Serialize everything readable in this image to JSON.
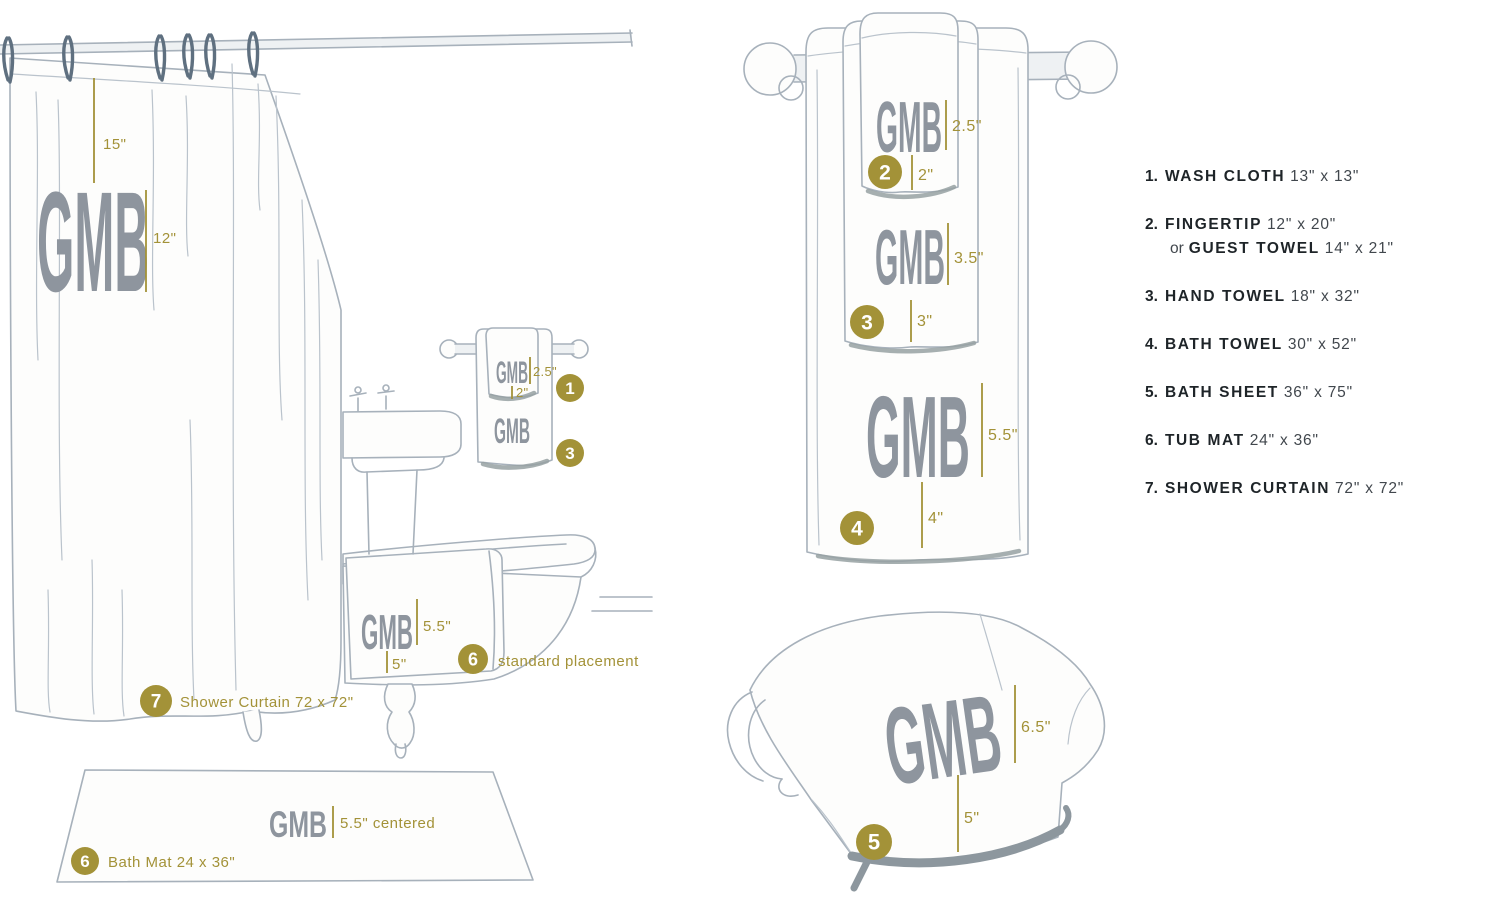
{
  "monogram": {
    "text": "GMB"
  },
  "colors": {
    "gold_accent": "#a39238",
    "monogram_gray": "#8e959e",
    "sketch_line": "#a7b1bb",
    "legend_dark": "#1e2428",
    "legend_size_text": "#41474d"
  },
  "scene": {
    "curtain": {
      "drop_label": "15\"",
      "monogram_label": "12\""
    },
    "sink_rack": {
      "washcloth_badge": "1",
      "washcloth_height": "2.5\"",
      "washcloth_offset": "2\"",
      "handtowel_badge": "3"
    },
    "tub_towel": {
      "height": "5.5\"",
      "offset": "5\"",
      "badge": "6",
      "note": "standard placement"
    },
    "curtain_caption": {
      "badge": "7",
      "label": "Shower Curtain 72 x 72\""
    },
    "bath_mat": {
      "badge": "6",
      "height": "5.5\" centered",
      "label": "Bath Mat 24 x 36\""
    }
  },
  "stack": {
    "fingertip": {
      "badge": "2",
      "height": "2.5\"",
      "offset": "2\""
    },
    "hand_towel": {
      "badge": "3",
      "height": "3.5\"",
      "offset": "3\""
    },
    "bath_towel": {
      "badge": "4",
      "height": "5.5\"",
      "offset": "4\""
    },
    "bath_sheet": {
      "badge": "5",
      "height": "6.5\"",
      "offset": "5\""
    }
  },
  "legend": {
    "items": [
      {
        "num": "1.",
        "name": "WASH CLOTH",
        "size": "13\" x 13\""
      },
      {
        "num": "2.",
        "name": "FINGERTIP",
        "size": "12\" x 20\"",
        "alt_prefix": "or",
        "alt_name": "GUEST TOWEL",
        "alt_size": "14\" x 21\""
      },
      {
        "num": "3.",
        "name": "HAND TOWEL",
        "size": "18\" x 32\""
      },
      {
        "num": "4.",
        "name": "BATH TOWEL",
        "size": "30\" x 52\""
      },
      {
        "num": "5.",
        "name": "BATH SHEET",
        "size": "36\" x 75\""
      },
      {
        "num": "6.",
        "name": "TUB MAT",
        "size": "24\" x 36\""
      },
      {
        "num": "7.",
        "name": "SHOWER CURTAIN",
        "size": "72\" x 72\""
      }
    ]
  }
}
